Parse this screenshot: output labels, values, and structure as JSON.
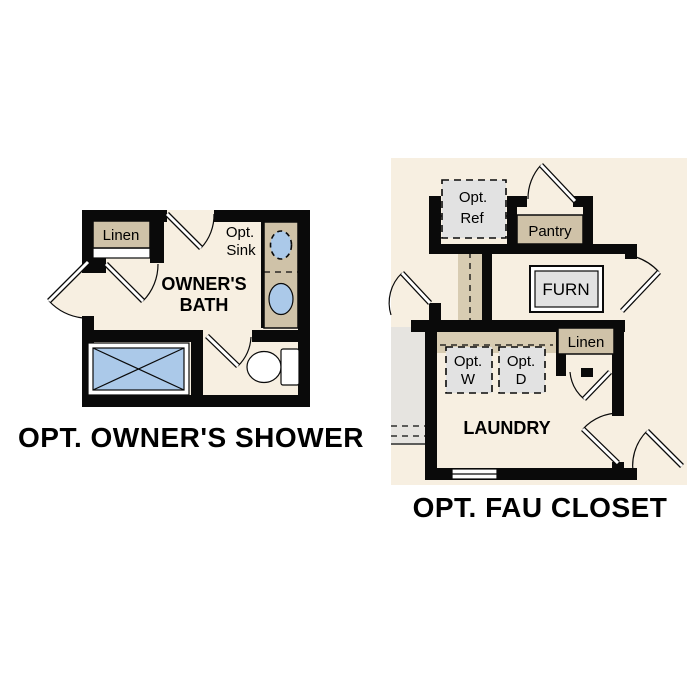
{
  "colors": {
    "floor": "#f7efe1",
    "wall": "#0a0a0a",
    "tan": "#cfc2a8",
    "tan-light": "#d8ccb2",
    "gray-box": "#e2e2e2",
    "gray-area": "#e6e4e0",
    "blue": "#abc9e9",
    "white": "#ffffff",
    "ink": "#000000"
  },
  "left_plan": {
    "title": "OPT. OWNER'S SHOWER",
    "labels": {
      "linen": "Linen",
      "opt_sink": [
        "Opt.",
        "Sink"
      ],
      "room": [
        "OWNER'S",
        "BATH"
      ]
    }
  },
  "right_plan": {
    "title": "OPT. FAU CLOSET",
    "labels": {
      "opt_ref": [
        "Opt.",
        "Ref"
      ],
      "pantry": "Pantry",
      "furn": "FURN",
      "linen": "Linen",
      "opt_w": [
        "Opt.",
        "W"
      ],
      "opt_d": [
        "Opt.",
        "D"
      ],
      "room": "LAUNDRY"
    }
  }
}
